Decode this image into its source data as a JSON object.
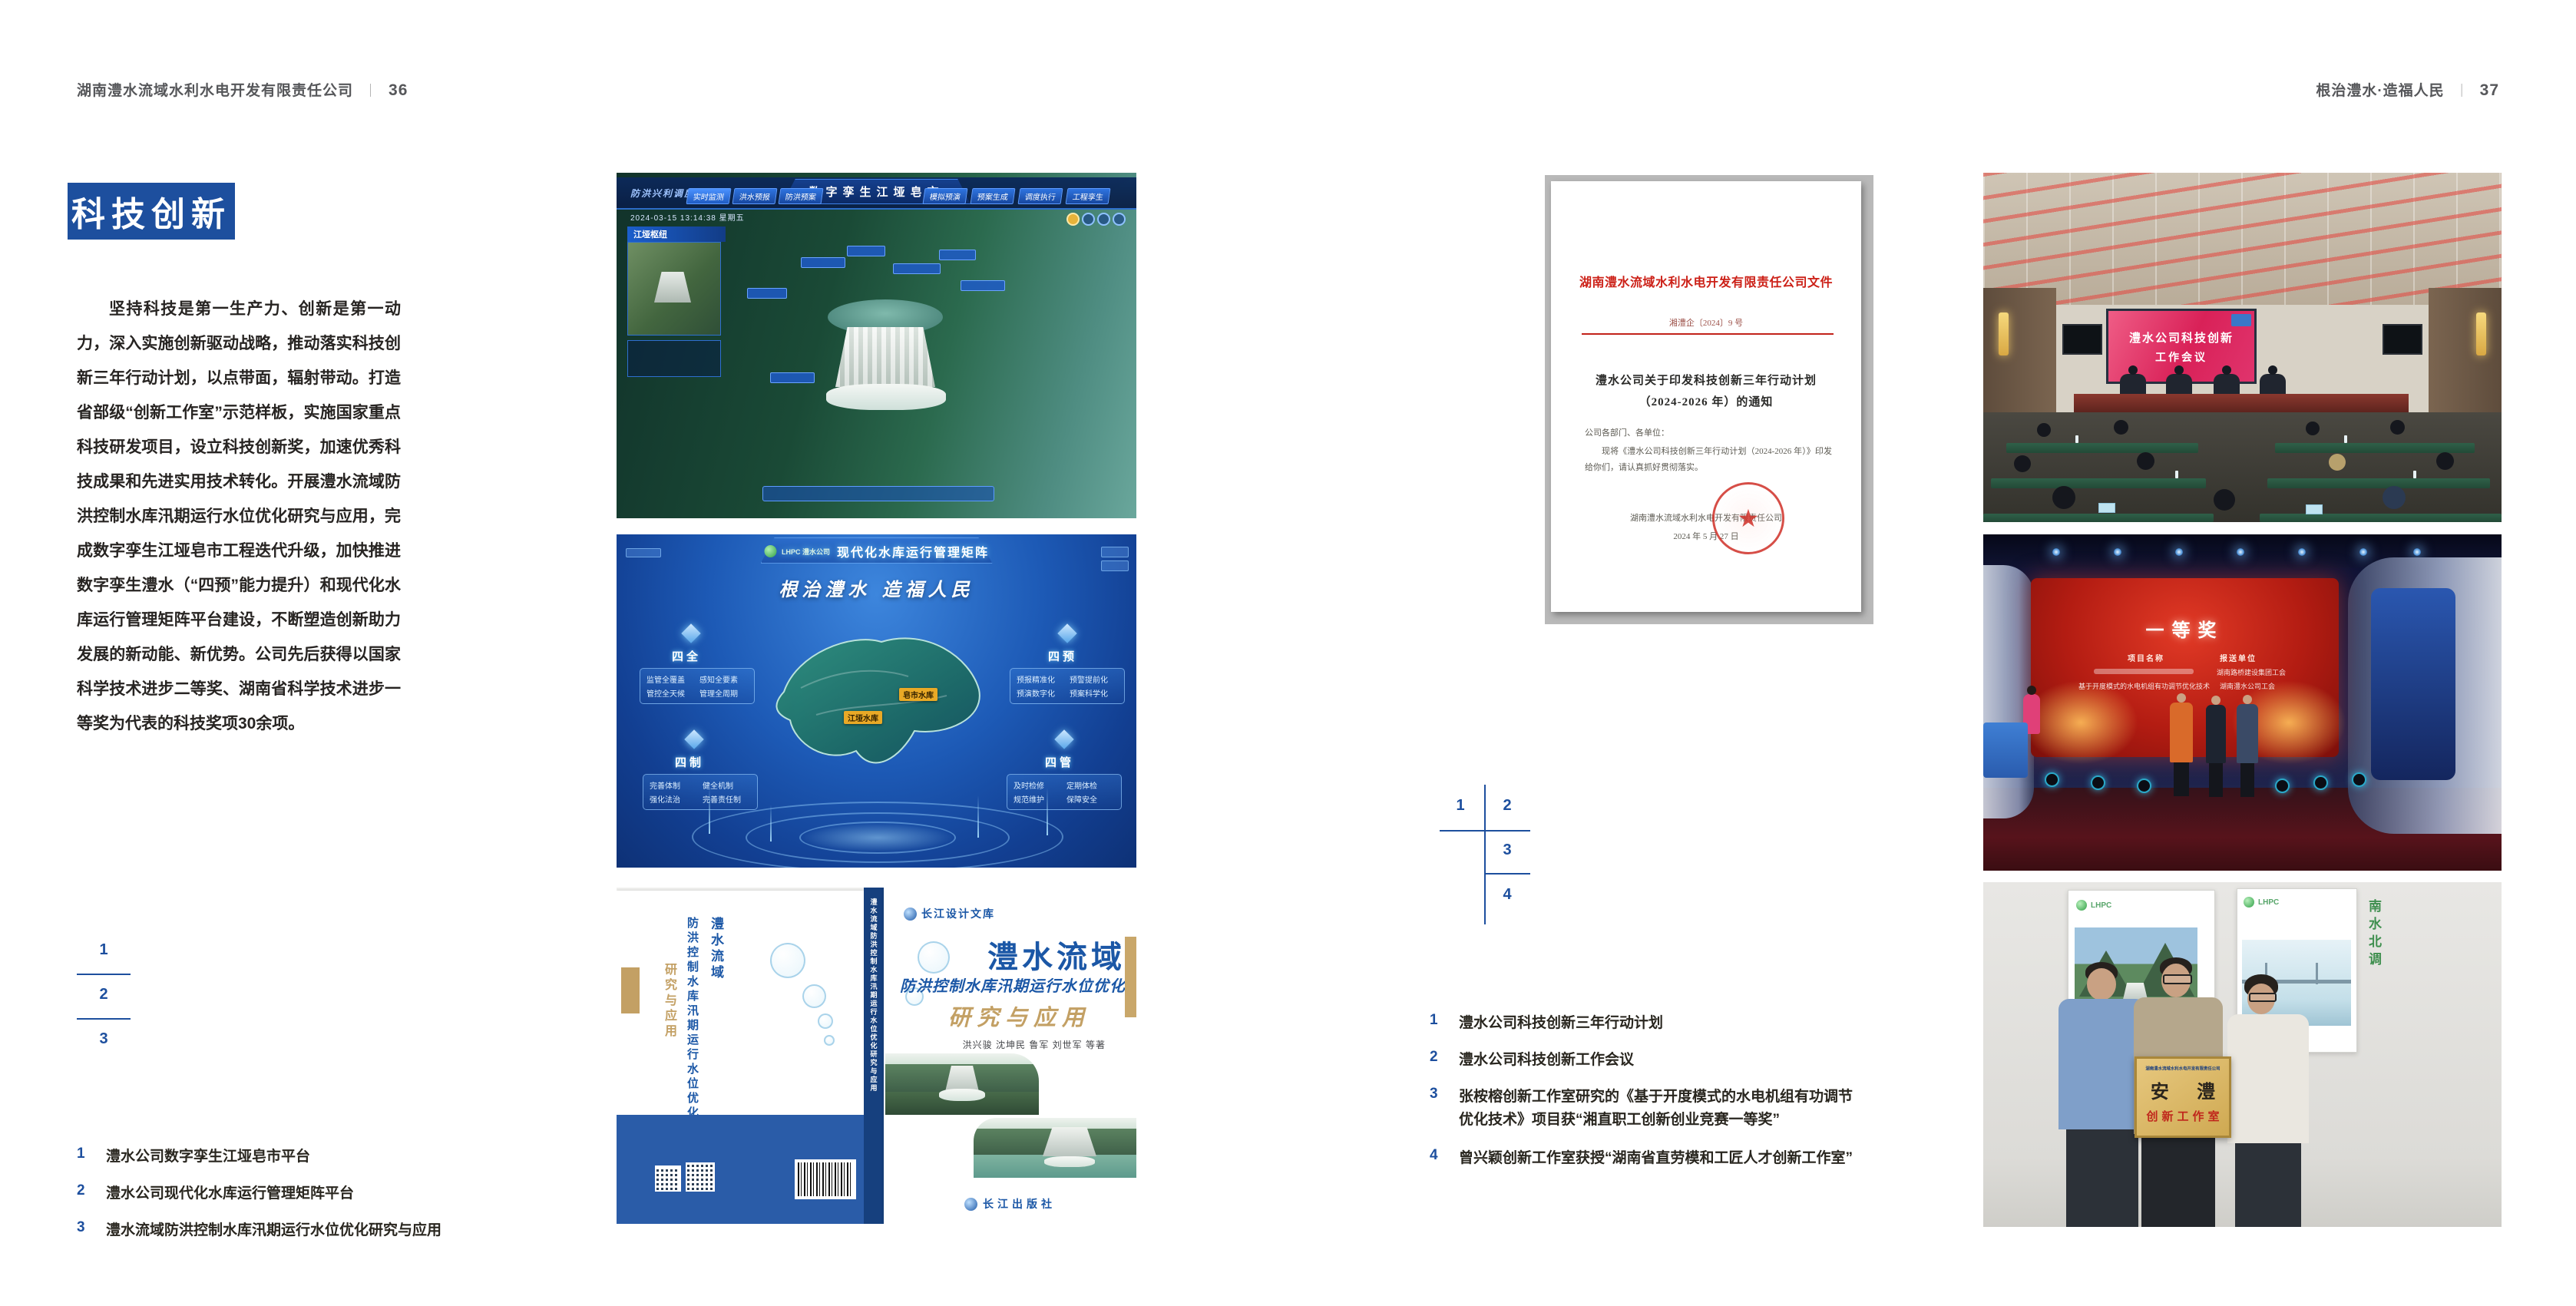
{
  "page_left": {
    "header": {
      "company": "湖南澧水流域水利水电开发有限责任公司",
      "separator": "｜",
      "page_number": "36"
    },
    "section_title": "科技创新",
    "paragraph": "坚持科技是第一生产力、创新是第一动力，深入实施创新驱动战略，推动落实科技创新三年行动计划，以点带面，辐射带动。打造省部级“创新工作室”示范样板，实施国家重点科技研发项目，设立科技创新奖，加速优秀科技成果和先进实用技术转化。开展澧水流域防洪控制水库汛期运行水位优化研究与应用，完成数字孪生江垭皂市工程迭代升级，加快推进数字孪生澧水（“四预”能力提升）和现代化水库运行管理矩阵平台建设，不断塑造创新助力发展的新动能、新优势。公司先后获得以国家科学技术进步二等奖、湖南省科学技术进步一等奖为代表的科技奖项30余项。",
    "figure_index": {
      "n1": "1",
      "n2": "2",
      "n3": "3"
    },
    "captions": [
      {
        "num": "1",
        "text": "澧水公司数字孪生江垭皂市平台"
      },
      {
        "num": "2",
        "text": "澧水公司现代化水库运行管理矩阵平台"
      },
      {
        "num": "3",
        "text": "澧水流域防洪控制水库汛期运行水位优化研究与应用"
      }
    ],
    "dashboard": {
      "title": "数字孪生江垭皂市",
      "left_tab": "防洪兴利调度",
      "nav_left": [
        "实时监测",
        "洪水预报",
        "防洪预案"
      ],
      "nav_right": [
        "模拟预演",
        "预案生成",
        "调度执行",
        "工程孪生"
      ],
      "timestamp": "2024-03-15 13:14:38 星期五",
      "panel_title": "江垭枢纽"
    },
    "matrix": {
      "logo_text": "LHPC 澧水公司",
      "title": "现代化水库运行管理矩阵",
      "slogan": "根治澧水 造福人民",
      "groups": [
        {
          "name": "四全",
          "items": [
            "监管全覆盖",
            "感知全要素",
            "管控全天候",
            "管理全周期"
          ]
        },
        {
          "name": "四预",
          "items": [
            "预报精准化",
            "预警提前化",
            "预演数字化",
            "预案科学化"
          ]
        },
        {
          "name": "四制",
          "items": [
            "完善体制",
            "健全机制",
            "强化法治",
            "完善责任制"
          ]
        },
        {
          "name": "四管",
          "items": [
            "及时检修",
            "定期体检",
            "规范维护",
            "保障安全"
          ]
        }
      ],
      "map_labels": [
        "皂市水库",
        "江垭水库"
      ]
    },
    "book": {
      "series": "长江设计文库",
      "title": "澧水流域",
      "subtitle": "防洪控制水库汛期运行水位优化",
      "subtitle2": "研究与应用",
      "authors": "洪兴骏 沈坤民 鲁军 刘世军 等著",
      "publisher": "长江出版社",
      "spine_title": "澧水流域防洪控制水库汛期运行水位优化研究与应用",
      "back_title_1": "澧水流域",
      "back_title_2": "防洪控制水库汛期运行水位优化",
      "back_subtitle": "研究与应用"
    }
  },
  "page_right": {
    "header": {
      "title": "根治澧水·造福人民",
      "separator": "｜",
      "page_number": "37"
    },
    "document": {
      "org_title": "湖南澧水流域水利水电开发有限责任公司文件",
      "doc_number": "湘澧企〔2024〕9 号",
      "subject_line1": "澧水公司关于印发科技创新三年行动计划",
      "subject_line2": "（2024-2026 年）的通知",
      "salutation": "公司各部门、各单位：",
      "body": "现将《澧水公司科技创新三年行动计划（2024-2026 年）》印发给你们，请认真抓好贯彻落实。",
      "signature": "湖南澧水流域水利水电开发有限责任公司",
      "date": "2024 年 5 月 27 日",
      "seal_star": "★"
    },
    "figure_index": {
      "n1": "1",
      "n2": "2",
      "n3": "3",
      "n4": "4"
    },
    "captions": [
      {
        "num": "1",
        "text": "澧水公司科技创新三年行动计划"
      },
      {
        "num": "2",
        "text": "澧水公司科技创新工作会议"
      },
      {
        "num": "3",
        "text": "张桉榕创新工作室研究的《基于开度模式的水电机组有功调节优化技术》项目获“湘直职工创新创业竞赛一等奖”"
      },
      {
        "num": "4",
        "text": "曾兴颖创新工作室获授“湖南省直劳模和工匠人才创新工作室”"
      }
    ],
    "meeting": {
      "screen_line1": "澧水公司科技创新",
      "screen_line2": "工作会议"
    },
    "award": {
      "title": "一等奖",
      "col1": "项目名称",
      "col2": "报送单位",
      "row2_project": "基于开度模式的水电机组有功调节优化技术",
      "row1_unit": "湖南路桥建设集团工会",
      "row2_unit": "湖南澧水公司工会"
    },
    "plaque": {
      "org": "湖南澧水流域水利水电开发有限责任公司",
      "name": "安 澧",
      "sub": "创新工作室",
      "poster2_vtext": "南水北调"
    }
  },
  "colors": {
    "accent_blue": "#1d4f9e",
    "doc_red": "#cc2017"
  }
}
